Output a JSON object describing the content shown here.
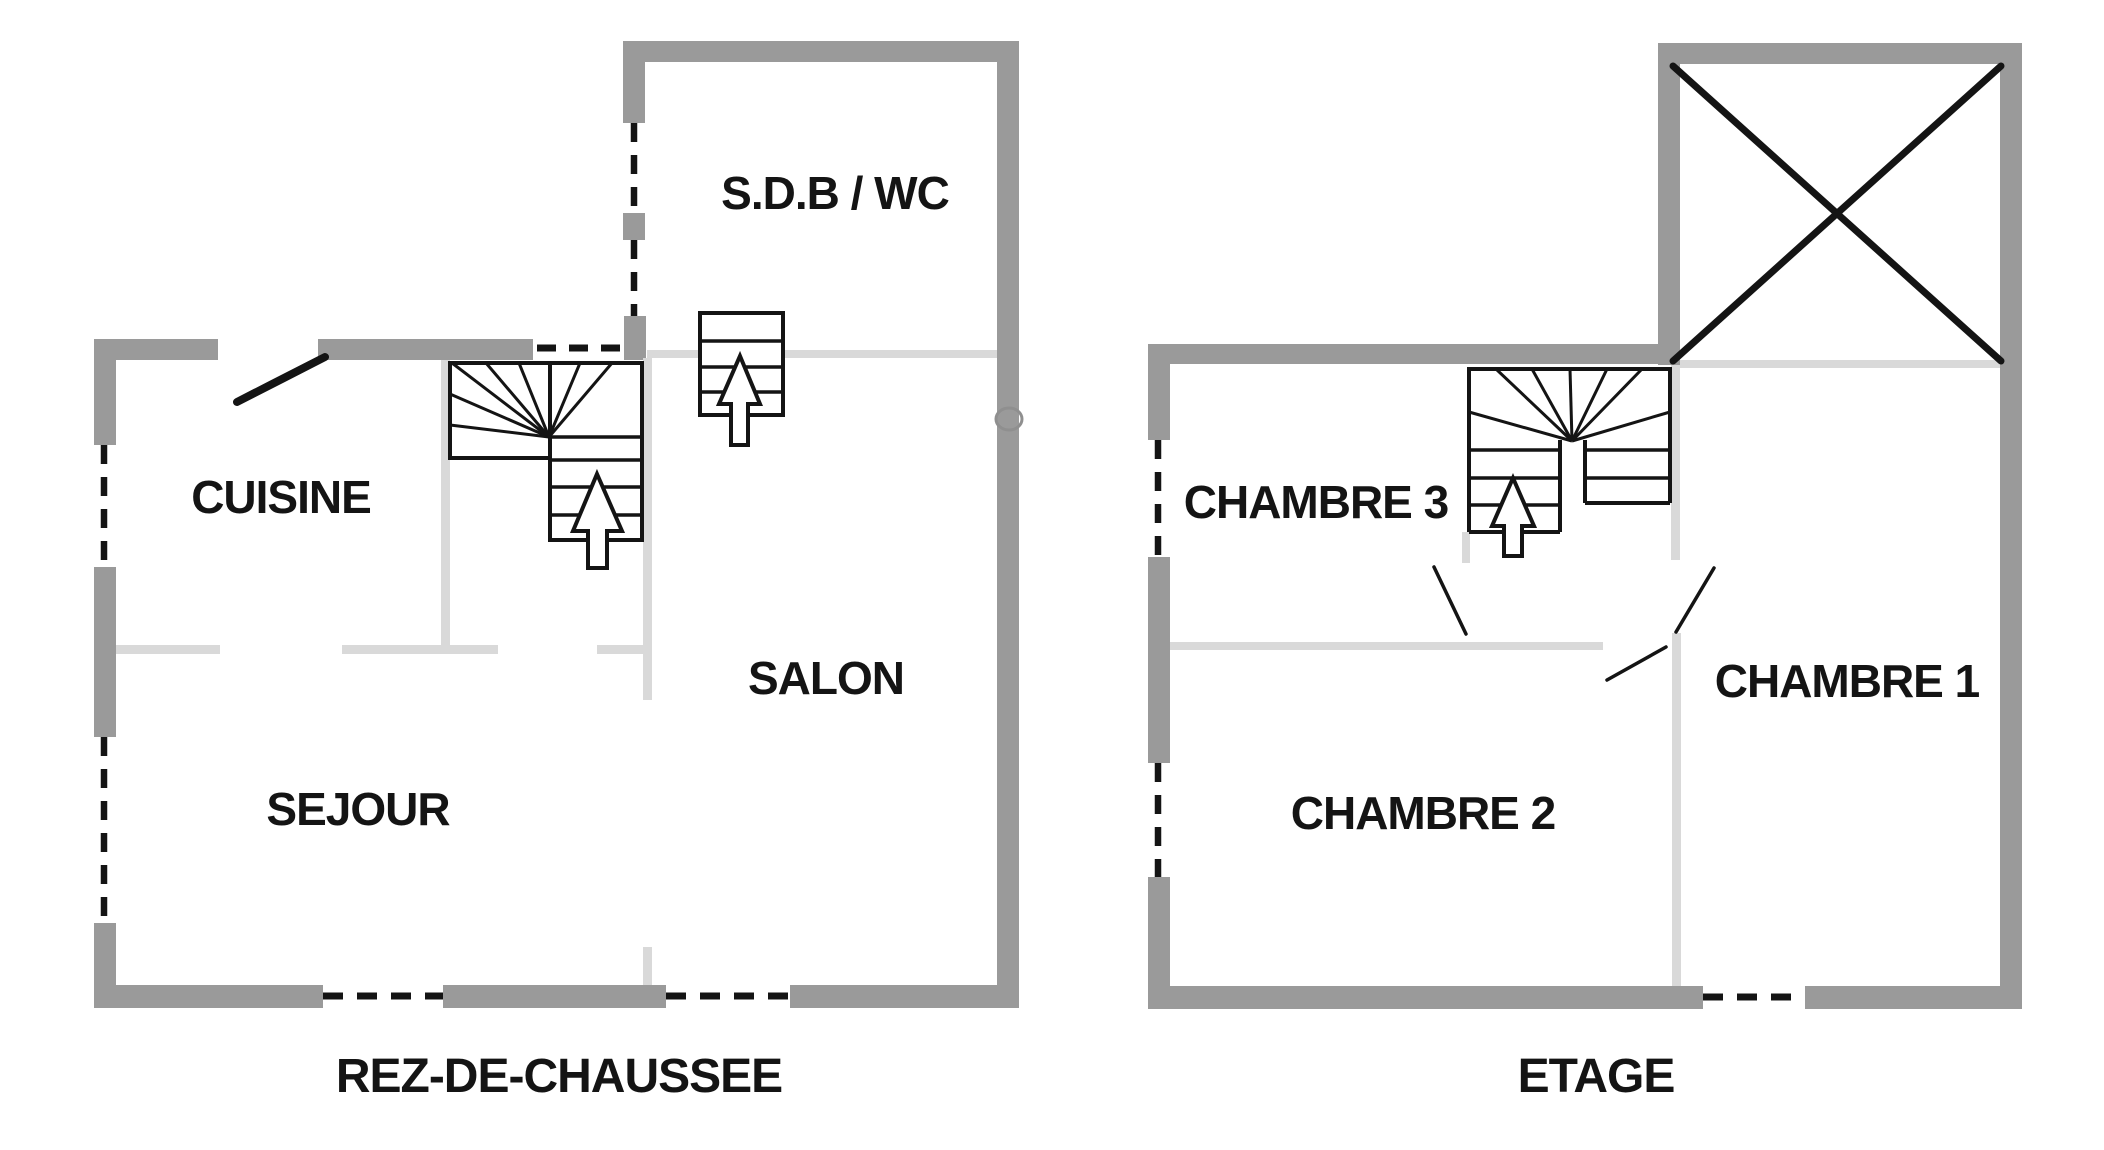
{
  "document": {
    "type": "floor-plan",
    "language": "fr"
  },
  "colors": {
    "wall": "#9a9a9a",
    "partition": "#d9d9d9",
    "line": "#141414",
    "text": "#141414",
    "background": "#ffffff"
  },
  "floors": [
    {
      "title": "REZ-DE-CHAUSSEE",
      "rooms": [
        {
          "label": "CUISINE"
        },
        {
          "label": "SEJOUR"
        },
        {
          "label": "SALON"
        },
        {
          "label": "S.D.B / WC"
        }
      ]
    },
    {
      "title": "ETAGE",
      "rooms": [
        {
          "label": "CHAMBRE 3"
        },
        {
          "label": "CHAMBRE 2"
        },
        {
          "label": "CHAMBRE 1"
        }
      ]
    }
  ]
}
